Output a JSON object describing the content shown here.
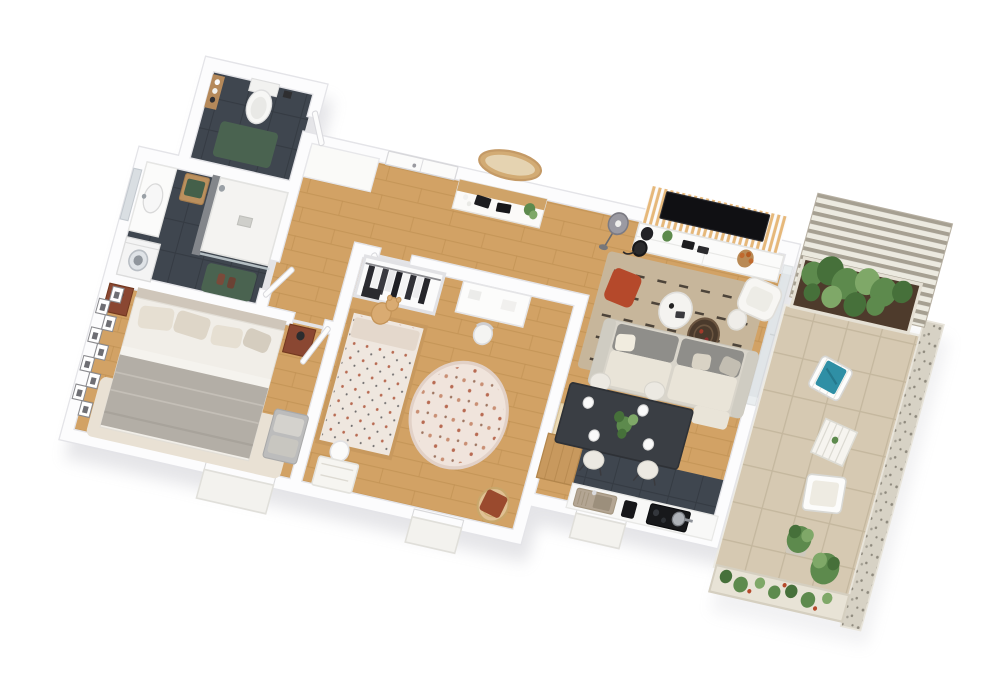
{
  "scene": {
    "type": "3d-floor-plan-render",
    "description": "Photorealistic top-down 3D floor plan of a two-bedroom apartment with terrace, rendered on a white background, plan rotated about 13 degrees",
    "projection": "top-down axonometric",
    "background_color": "#ffffff"
  },
  "palette": {
    "bg": "#ffffff",
    "wall": "#fcfcfd",
    "wallEdge": "#e4e4e8",
    "shadow": "#a2a2ad",
    "wood": "#d2a265",
    "woodLine": "#bf8f52",
    "darkTile": "#3f464f",
    "darkTileLine": "#343a42",
    "terrace": "#d6c9b2",
    "terraceLine": "#c2b59d",
    "gravel": "#d7d2c5",
    "gravelDot": "#8e897d",
    "mat": "#4a6350",
    "white": "#f8f8f7",
    "cream": "#e9e4d8",
    "sofaGray": "#8f8e8a",
    "sofaBase": "#d9d5cb",
    "rug": "#c7b69b",
    "rugDash": "#38312a",
    "bedRug": "#e9e1d4",
    "blanket": "#b3aea6",
    "mattress": "#f1eee8",
    "pillow": "#e6dfd2",
    "nightstand": "#8a4732",
    "woodFurn": "#c8995e",
    "beigeCube": "#ead9b4",
    "table": "#3a3e44",
    "chair": "#ece9e2",
    "rust": "#b5492b",
    "teal": "#2f8fa5",
    "slat": "#e6b87a",
    "tv": "#101013",
    "pergola": "#a49d8f",
    "pergolaLight": "#eceadf",
    "plant": "#5d8a4d",
    "plantDark": "#46703a",
    "plantLight": "#7fa868",
    "soil": "#4e3b2c",
    "childRug": "#f0e4dc",
    "childPattern": "#c98f74",
    "bedding": "#efe7df",
    "teddy": "#d9ab72",
    "sink": "#b3a593",
    "appliance": "#17171a",
    "steel": "#aeb2b8",
    "mirrorWood": "#d2ab74",
    "glass": "#dfe6e9"
  },
  "rooms": [
    {
      "id": "wc",
      "name": "Toilet room",
      "floor": "dark tile",
      "items": [
        "toilet",
        "wooden wall shelf with jars",
        "green bath mat",
        "toilet paper holder"
      ]
    },
    {
      "id": "bathroom",
      "name": "Bathroom",
      "floor": "dark tile",
      "items": [
        "vanity with sink",
        "wall mirror",
        "washing machine",
        "walk-in shower with white tray",
        "gray tiled shower wall",
        "glass screen",
        "wooden stool with green towel",
        "green bath mat with slippers"
      ]
    },
    {
      "id": "bedroom",
      "name": "Master bedroom",
      "floor": "oak parquet",
      "items": [
        "double bed with gray blanket",
        "four pillows",
        "nightstand with lamp left",
        "nightstand with lamp right",
        "gallery wall of nine framed pictures",
        "light area rug",
        "gray upholstered bench",
        "window with outside sill",
        "open door"
      ]
    },
    {
      "id": "hallway",
      "name": "Entry hallway",
      "floor": "oak parquet",
      "items": [
        "front door",
        "white sideboard",
        "console table with books and plant",
        "oval wood-framed wall mirror"
      ]
    },
    {
      "id": "kids-room",
      "name": "Kids bedroom",
      "floor": "oak parquet",
      "items": [
        "open wardrobe with hanging clothes",
        "house-frame bed with patterned bedding",
        "teddy bear",
        "round patterned rug",
        "white desk",
        "desk chair",
        "round white stool",
        "rattan chair with rust cushion",
        "toy bin",
        "window with outside sill",
        "open door"
      ]
    },
    {
      "id": "living-room",
      "name": "Living room",
      "floor": "oak parquet",
      "items": [
        "wood slat TV wall",
        "flat screen TV",
        "white media console with decor",
        "floor lamp with gray shade",
        "black arc lamp",
        "striped beige rug",
        "rust pouf",
        "round white coffee table",
        "dark woven tray table",
        "small side table",
        "gray and cream sofa with chaise and cushions",
        "white armchair",
        "glass door to terrace"
      ]
    },
    {
      "id": "dining",
      "name": "Dining area",
      "floor": "oak parquet",
      "items": [
        "dark rectangular dining table",
        "four upholstered chairs",
        "green plant centerpiece",
        "four place settings"
      ]
    },
    {
      "id": "kitchen",
      "name": "Kitchen",
      "floor": "dark tile strip",
      "items": [
        "white counter along outer wall",
        "sink with drainboard and faucet",
        "black coffee machine",
        "black cooktop with steel pot",
        "tall wooden cabinet",
        "beige cube cabinet",
        "window with outside sill"
      ]
    },
    {
      "id": "terrace",
      "name": "Terrace",
      "floor": "beige tiles",
      "items": [
        "pergola with slatted roof",
        "long planter with green shrubs",
        "outdoor chair with teal towel",
        "slatted outdoor table",
        "outdoor bench with cushion",
        "two potted plants",
        "flower planter boxes",
        "gravel border"
      ]
    }
  ]
}
